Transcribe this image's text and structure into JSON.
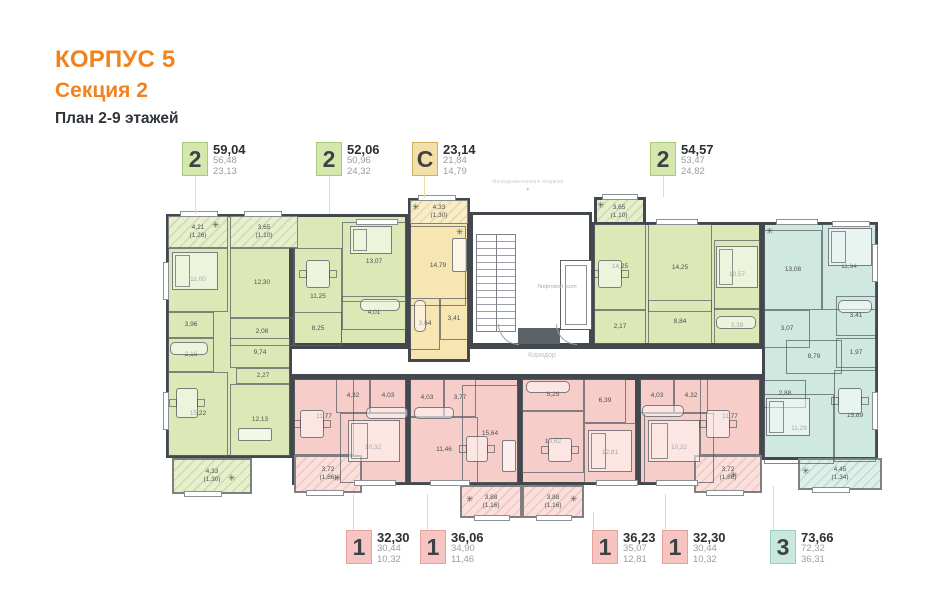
{
  "title": {
    "building": "КОРПУС 5",
    "section": "Секция 2",
    "plan": "План 2-9 этажей"
  },
  "colors": {
    "accent": "#F0831F",
    "green": "#DCE9B6",
    "yellow": "#F7E6B2",
    "pink": "#F7CDC9",
    "teal": "#CFE9E0",
    "wall": "#43484E"
  },
  "core": {
    "elevator_hall": "Лифтовой холл",
    "corridor": "Коридор",
    "top_note": "Незадымляемая лоджия"
  },
  "icons": {
    "plant": "✳",
    "arrow_down": "▾"
  },
  "callouts": {
    "top": [
      {
        "type": "2",
        "total": "59,04",
        "net": "56,48",
        "living": "23,13"
      },
      {
        "type": "2",
        "total": "52,06",
        "net": "50,96",
        "living": "24,32"
      },
      {
        "type": "С",
        "total": "23,14",
        "net": "21,84",
        "living": "14,79"
      },
      {
        "type": "2",
        "total": "54,57",
        "net": "53,47",
        "living": "24,82"
      }
    ],
    "bottom": [
      {
        "type": "1",
        "total": "32,30",
        "net": "30,44",
        "living": "10,32"
      },
      {
        "type": "1",
        "total": "36,06",
        "net": "34,90",
        "living": "11,46"
      },
      {
        "type": "1",
        "total": "36,23",
        "net": "35,07",
        "living": "12,81"
      },
      {
        "type": "1",
        "total": "32,30",
        "net": "30,44",
        "living": "10,32"
      },
      {
        "type": "3",
        "total": "73,66",
        "net": "72,32",
        "living": "36,31"
      }
    ]
  },
  "rooms": {
    "a_balc": {
      "a": "4,21",
      "r": "(1,26)"
    },
    "a_bed": "11,00",
    "a_396": "3,96",
    "a_216": "2,16",
    "a_kit": "15,22",
    "a_hall": "9,74",
    "a_227": "2,27",
    "a_bed2": "12,13",
    "a_balc2": {
      "a": "4,33",
      "r": "(1,30)"
    },
    "b_balc": {
      "a": "3,65",
      "r": "(1,10)"
    },
    "b_kit": "12,30",
    "b_bath": "2,08",
    "b_liv": "11,25",
    "b_bed": "13,07",
    "b_401": "4,01",
    "b_hall": "8,25",
    "c_balc": {
      "a": "4,33",
      "r": "(1,30)"
    },
    "c_main": "14,79",
    "c_364": "3,64",
    "c_341": "3,41",
    "d_balc": {
      "a": "3,65",
      "r": "(1,10)"
    },
    "d_kit": "14,25",
    "d_217": "2,17",
    "d_liv": "14,25",
    "d_hall": "8,84",
    "d_bed": "10,57",
    "d_339": "3,39",
    "e_cab": "13,08",
    "e_bed": "11,94",
    "e_341": "3,41",
    "e_307": "3,07",
    "e_hall": "8,79",
    "e_197": "1,97",
    "e_288": "2,88",
    "e_bed2": "11,29",
    "e_kit": "15,89",
    "e_balc": {
      "a": "4,45",
      "r": "(1,34)"
    },
    "f_liv": "11,77",
    "f_432": "4,32",
    "f_403": "4,03",
    "f_bed": "10,32",
    "f_balc": {
      "a": "3,72",
      "r": "(1,86)"
    },
    "g_403": "4,03",
    "g_377": "3,77",
    "g_bed": "11,46",
    "g_liv": "15,64",
    "g_balc": {
      "a": "3,88",
      "r": "(1,16)"
    },
    "h_525": "5,25",
    "h_kit": "10,62",
    "h_639": "6,39",
    "h_bed": "12,81",
    "h_balc": {
      "a": "3,88",
      "r": "(1,16)"
    },
    "i_403": "4,03",
    "i_432": "4,32",
    "i_liv": "11,77",
    "i_bed": "10,32",
    "i_balc": {
      "a": "3,72",
      "r": "(1,86)"
    }
  }
}
